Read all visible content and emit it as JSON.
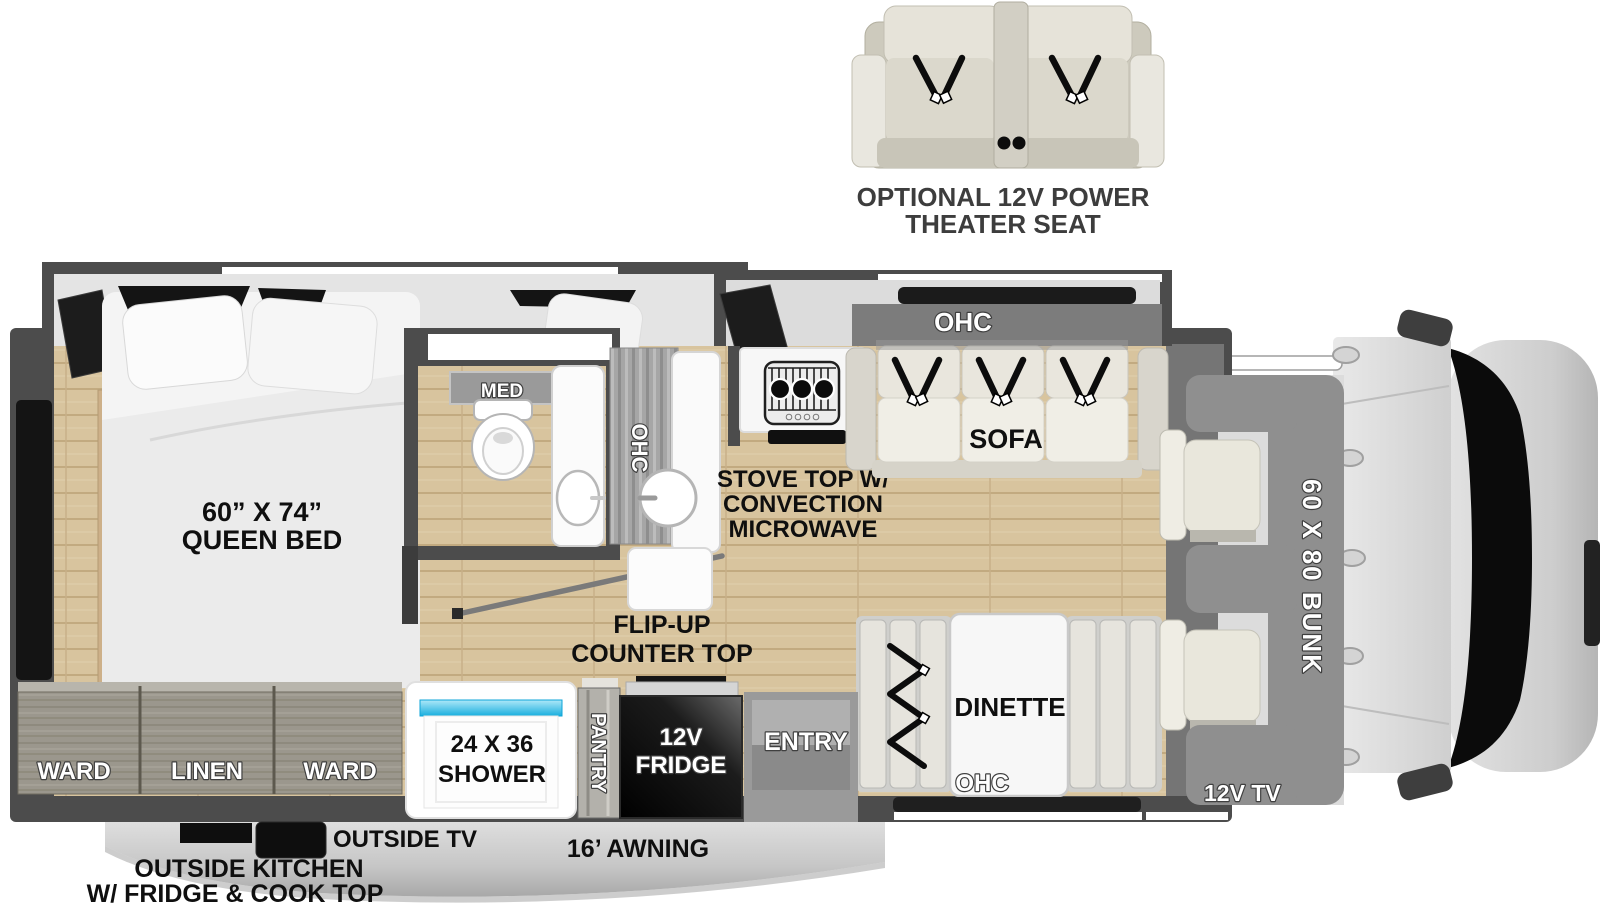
{
  "optional_item": {
    "line1": "OPTIONAL 12V POWER",
    "line2": "THEATER SEAT"
  },
  "labels": {
    "queen_bed_line1": "60” X 74”",
    "queen_bed_line2": "QUEEN BED",
    "med": "MED",
    "ohc_kitchen": "OHC",
    "ohc_sofa": "OHC",
    "ohc_dinette": "OHC",
    "sofa": "SOFA",
    "stove_line1": "STOVE TOP W/",
    "stove_line2": "CONVECTION",
    "stove_line3": "MICROWAVE",
    "flip_up_line1": "FLIP-UP",
    "flip_up_line2": "COUNTER TOP",
    "dinette": "DINETTE",
    "entry": "ENTRY",
    "pantry": "PANTRY",
    "fridge_line1": "12V",
    "fridge_line2": "FRIDGE",
    "shower_line1": "24 X 36",
    "shower_line2": "SHOWER",
    "ward_left": "WARD",
    "linen": "LINEN",
    "ward_right": "WARD",
    "bunk": "60 X 80 BUNK",
    "front_tv": "12V TV",
    "outside_tv": "OUTSIDE TV",
    "awning": "16’ AWNING",
    "outside_kitchen_line1": "OUTSIDE KITCHEN",
    "outside_kitchen_line2": "W/ FRIDGE & COOK TOP"
  },
  "colors": {
    "wall": "#4c4c4c",
    "floor_wood": "#d8c49e",
    "slide_interior": "#e2e2e2",
    "cabinet_gray": "#9b978d",
    "fridge_black": "#0e0e0e",
    "shower_blue": "#1fb4e8",
    "bunk_gray": "#8f8f8f",
    "label_black": "#0f0f0f",
    "label_white": "#ffffff",
    "awning_gray": "#c9c9c9"
  }
}
